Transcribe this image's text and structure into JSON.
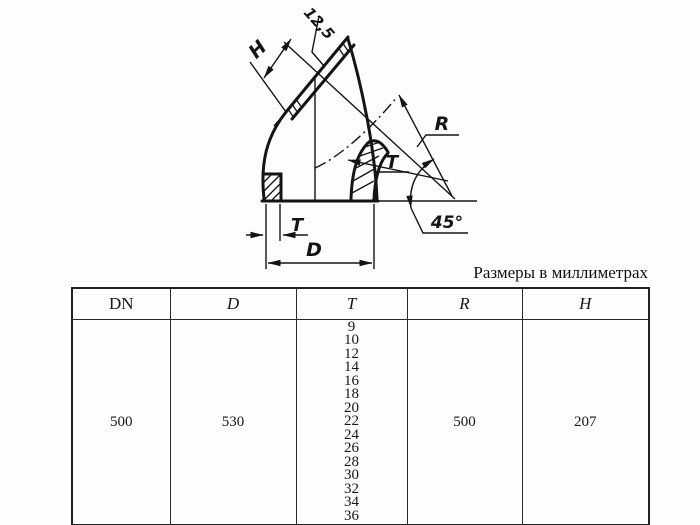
{
  "caption": "Размеры в миллиметрах",
  "drawing": {
    "labels": {
      "height": "H",
      "roughness": "12,5",
      "radius": "R",
      "wall_mid": "T",
      "angle": "45°",
      "wall_bottom": "T",
      "outer_diameter": "D"
    }
  },
  "table": {
    "headers": [
      "DN",
      "D",
      "T",
      "R",
      "H"
    ],
    "row": {
      "dn": "500",
      "d": "530",
      "t_values": [
        "9",
        "10",
        "12",
        "14",
        "16",
        "18",
        "20",
        "22",
        "24",
        "26",
        "28",
        "30",
        "32",
        "34",
        "36"
      ],
      "r": "500",
      "h": "207"
    }
  }
}
